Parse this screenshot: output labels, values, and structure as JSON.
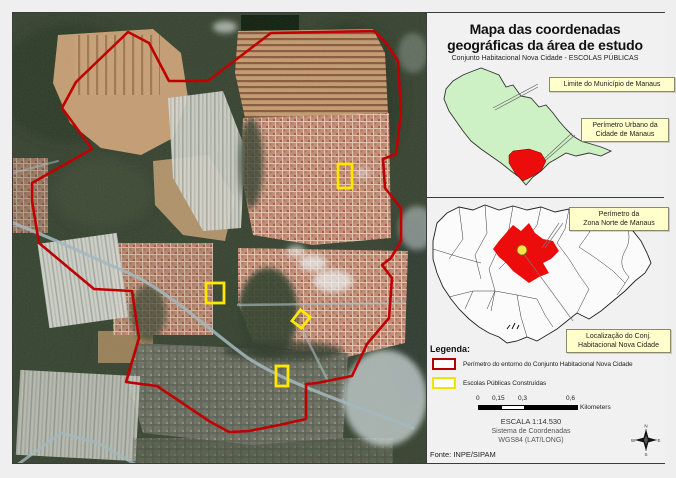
{
  "page": {
    "title_line1": "Mapa das coordenadas",
    "title_line2": "geográficas da área de estudo",
    "subtitle": "Conjunto Habitacional Nova Cidade - ESCOLAS PÚBLICAS"
  },
  "inset_municipality": {
    "label_limite": "Limite do Município de Manaus",
    "label_perimetro_line1": "Perímetro Urbano da",
    "label_perimetro_line2": "Cidade de Manaus"
  },
  "inset_zona_norte": {
    "label_perimetro_line1": "Perímetro da",
    "label_perimetro_line2": "Zona Norte de Manaus",
    "label_localizacao_line1": "Localização do Conj.",
    "label_localizacao_line2": "Habitacional Nova Cidade"
  },
  "legend": {
    "heading": "Legenda:",
    "items": [
      {
        "label": "Perímetro do entorno do Conjunto Habitacional Nova Cidade",
        "swatch_color": "#b40000"
      },
      {
        "label": "Escolas Públicas Construídas",
        "swatch_color": "#f3e400"
      }
    ]
  },
  "scale_bar": {
    "ticks": [
      "0",
      "0,15",
      "0,3",
      "0,6"
    ],
    "unit": "Kilometers"
  },
  "scale_info": {
    "escala": "ESCALA  1:14.530",
    "coord_line1": "Sistema de Coordenadas",
    "coord_line2": "WGS84 (LAT/LONG)"
  },
  "source_note": "Fonte: INPE/SIPAM",
  "compass": {
    "n": "N",
    "s": "S",
    "e": "E",
    "w": "W"
  },
  "colors": {
    "perimeter_red": "#c00000",
    "school_yellow": "#ffe800",
    "municipality_fill": "#cdf0c5",
    "urban_zone_red": "#ec0c0c",
    "label_background": "#ffffcc"
  }
}
